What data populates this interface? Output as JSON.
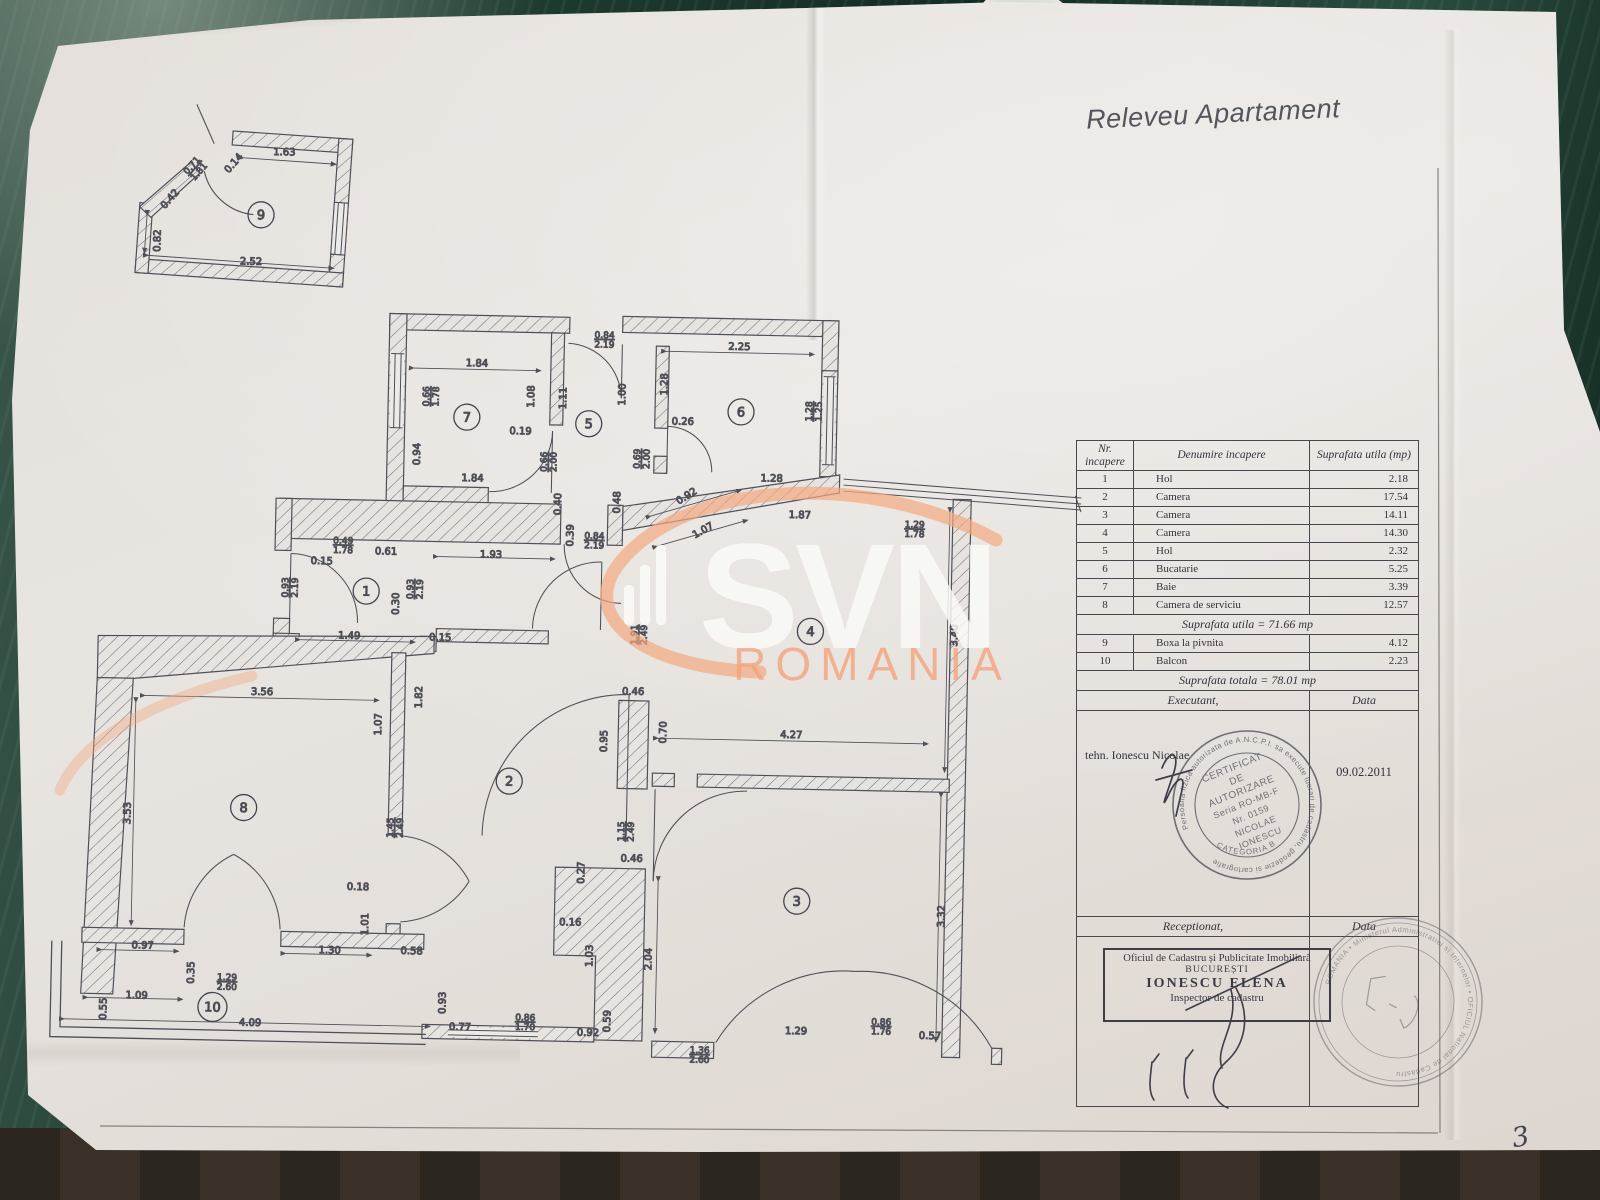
{
  "page": {
    "title": "Releveu Apartament",
    "page_number": "3"
  },
  "watermark": {
    "brand": "SVN",
    "sub": "ROMANIA",
    "accent": "#f2a982"
  },
  "table": {
    "headers": [
      "Nr. incapere",
      "Denumire incapere",
      "Suprafata utila (mp)"
    ],
    "body": [
      {
        "cells": [
          "1",
          "Hol",
          "2.18"
        ]
      },
      {
        "cells": [
          "2",
          "Camera",
          "17.54"
        ]
      },
      {
        "cells": [
          "3",
          "Camera",
          "14.11"
        ]
      },
      {
        "cells": [
          "4",
          "Camera",
          "14.30"
        ]
      },
      {
        "cells": [
          "5",
          "Hol",
          "2.32"
        ]
      },
      {
        "cells": [
          "6",
          "Bucatarie",
          "5.25"
        ]
      },
      {
        "cells": [
          "7",
          "Baie",
          "3.39"
        ]
      },
      {
        "cells": [
          "8",
          "Camera de serviciu",
          "12.57"
        ]
      },
      {
        "merge": "Suprafata utila = 71.66 mp"
      },
      {
        "cells": [
          "9",
          "Boxa  la pivnita",
          "4.12"
        ]
      },
      {
        "cells": [
          "10",
          "Balcon",
          "2.23"
        ]
      },
      {
        "merge": "Suprafata totala = 78.01 mp"
      },
      {
        "pair": [
          "Executant,",
          "Data"
        ]
      },
      {
        "tall": true,
        "left": "tehn. Ionescu Nicolae",
        "right": "09.02.2011",
        "h": 206
      },
      {
        "pair": [
          "Receptionat,",
          "Data"
        ]
      },
      {
        "tall": true,
        "left": "",
        "right": "",
        "h": 170
      }
    ]
  },
  "stamps": {
    "certificat": {
      "ring": "Persoana fizica autorizata de A.N.C.P.I. sa execute lucrari de cadastru, geodezie si cartografie",
      "lines": [
        "CERTIFICAT",
        "DE",
        "AUTORIZARE",
        "Seria RO-MB-F",
        "Nr. 0159",
        "NICOLAE",
        "IONESCU"
      ],
      "category": "CATEGORIA B"
    },
    "ocpi": {
      "lines": [
        "Oficiul de Cadastru și Publicitate Imobiliară",
        "BUCUREȘTI",
        "IONESCU ELENA",
        "Inspector de cadastru"
      ]
    },
    "round2": {
      "ring": "ROMANIA • Ministerul Administratiei si Internelor • OFICIUL National de Cadastru"
    }
  },
  "plan": {
    "rooms": [
      {
        "n": "1",
        "x": 365,
        "y": 596
      },
      {
        "n": "2",
        "x": 512,
        "y": 783
      },
      {
        "n": "3",
        "x": 802,
        "y": 897
      },
      {
        "n": "4",
        "x": 810,
        "y": 627
      },
      {
        "n": "5",
        "x": 584,
        "y": 424
      },
      {
        "n": "6",
        "x": 736,
        "y": 409
      },
      {
        "n": "7",
        "x": 462,
        "y": 420
      },
      {
        "n": "8",
        "x": 247,
        "y": 815
      },
      {
        "n": "9",
        "x": 252,
        "y": 222
      },
      {
        "n": "10",
        "x": 220,
        "y": 1015
      }
    ],
    "labels": [
      {
        "t": "1.63",
        "x": 274,
        "y": 162
      },
      {
        "t": "0.14",
        "x": 226,
        "y": 173,
        "r": -50
      },
      {
        "t": "0.71",
        "t2": "1.81",
        "x": 184,
        "y": 176,
        "r": -50
      },
      {
        "t": "0.42",
        "x": 163,
        "y": 210,
        "r": -50
      },
      {
        "t": "0.82",
        "x": 152,
        "y": 250,
        "r": -90
      },
      {
        "t": "2.52",
        "x": 243,
        "y": 272
      },
      {
        "t": "1.84",
        "x": 471,
        "y": 369
      },
      {
        "t": "0.66",
        "t2": "1.78",
        "x": 424,
        "y": 400,
        "r": -90
      },
      {
        "t": "0.94",
        "x": 416,
        "y": 458,
        "r": -90
      },
      {
        "t": "1.84",
        "x": 469,
        "y": 484
      },
      {
        "t": "1.08",
        "x": 529,
        "y": 398,
        "r": -90
      },
      {
        "t": "0.19",
        "x": 516,
        "y": 436
      },
      {
        "t": "1.11",
        "x": 561,
        "y": 399,
        "r": -90
      },
      {
        "t": "0.84",
        "t2": "2.19",
        "x": 598,
        "y": 338
      },
      {
        "t": "1.00",
        "x": 620,
        "y": 394,
        "r": -90
      },
      {
        "t": "0.66",
        "t2": "2.00",
        "x": 543,
        "y": 463,
        "r": -90
      },
      {
        "t": "0.69",
        "t2": "2.00",
        "x": 636,
        "y": 458,
        "r": -90
      },
      {
        "t": "2.25",
        "x": 733,
        "y": 347
      },
      {
        "t": "1.28",
        "x": 662,
        "y": 383,
        "r": -90
      },
      {
        "t": "0.26",
        "x": 678,
        "y": 423
      },
      {
        "t": "1.28",
        "t2": "1.25",
        "x": 807,
        "y": 407,
        "r": -90
      },
      {
        "t": "1.28",
        "x": 768,
        "y": 478
      },
      {
        "t": "0.92",
        "x": 685,
        "y": 497,
        "r": -33
      },
      {
        "t": "0.40",
        "x": 558,
        "y": 505,
        "r": -90
      },
      {
        "t": "0.48",
        "x": 617,
        "y": 502,
        "r": -90
      },
      {
        "t": "0.39",
        "x": 571,
        "y": 536,
        "r": -90
      },
      {
        "t": "0.84",
        "t2": "2.19",
        "x": 592,
        "y": 539
      },
      {
        "t": "0.49",
        "t2": "1.78",
        "x": 341,
        "y": 549
      },
      {
        "t": "0.61",
        "x": 384,
        "y": 559
      },
      {
        "t": "1.93",
        "x": 489,
        "y": 560
      },
      {
        "t": "0.15",
        "x": 320,
        "y": 570
      },
      {
        "t": "0.93",
        "t2": "2.19",
        "x": 287,
        "y": 594,
        "r": -90
      },
      {
        "t": "0.93",
        "t2": "2.19",
        "x": 412,
        "y": 593,
        "r": -90
      },
      {
        "t": "0.30",
        "x": 398,
        "y": 608,
        "r": -90
      },
      {
        "t": "1.49",
        "x": 349,
        "y": 644
      },
      {
        "t": "0.15",
        "x": 440,
        "y": 644
      },
      {
        "t": "1.87",
        "x": 797,
        "y": 514
      },
      {
        "t": "1.07",
        "x": 702,
        "y": 531,
        "r": -30
      },
      {
        "t": "1.29",
        "t2": "1.78",
        "x": 912,
        "y": 521
      },
      {
        "t": "3.40",
        "x": 957,
        "y": 628,
        "r": -90
      },
      {
        "t": "1.91",
        "t2": "2.49",
        "x": 637,
        "y": 634,
        "r": -90
      },
      {
        "t": "0.46",
        "x": 634,
        "y": 694
      },
      {
        "t": "0.70",
        "x": 668,
        "y": 731,
        "r": -90
      },
      {
        "t": "0.95",
        "x": 609,
        "y": 741,
        "r": -90
      },
      {
        "t": "4.27",
        "x": 793,
        "y": 734
      },
      {
        "t": "3.56",
        "x": 263,
        "y": 702
      },
      {
        "t": "1.82",
        "x": 423,
        "y": 701,
        "r": -90
      },
      {
        "t": "1.07",
        "x": 383,
        "y": 729,
        "r": -90
      },
      {
        "t": "3.53",
        "x": 134,
        "y": 823,
        "r": -90
      },
      {
        "t": "1.45",
        "t2": "2.49",
        "x": 397,
        "y": 832,
        "r": -90
      },
      {
        "t": "1.15",
        "t2": "2.49",
        "x": 628,
        "y": 831,
        "r": -90
      },
      {
        "t": "0.46",
        "x": 636,
        "y": 861
      },
      {
        "t": "0.27",
        "x": 589,
        "y": 873,
        "r": -90
      },
      {
        "t": "0.16",
        "x": 576,
        "y": 926
      },
      {
        "t": "1.03",
        "x": 599,
        "y": 956,
        "r": -90
      },
      {
        "t": "2.04",
        "x": 658,
        "y": 958,
        "r": -90
      },
      {
        "t": "0.93",
        "x": 453,
        "y": 1006,
        "r": -90
      },
      {
        "t": "0.77",
        "x": 468,
        "y": 1033
      },
      {
        "t": "0.86",
        "t2": "1.70",
        "x": 533,
        "y": 1022
      },
      {
        "t": "0.92",
        "x": 596,
        "y": 1036
      },
      {
        "t": "0.59",
        "x": 618,
        "y": 1021,
        "r": -90
      },
      {
        "t": "1.36",
        "t2": "2.60",
        "x": 708,
        "y": 1051
      },
      {
        "t": "3.32",
        "x": 950,
        "y": 909,
        "r": -90
      },
      {
        "t": "1.29",
        "x": 804,
        "y": 1030
      },
      {
        "t": "0.86",
        "t2": "1.76",
        "x": 889,
        "y": 1019
      },
      {
        "t": "0.57",
        "x": 938,
        "y": 1032
      },
      {
        "t": "0.18",
        "x": 363,
        "y": 895
      },
      {
        "t": "1.01",
        "x": 374,
        "y": 929,
        "r": -90
      },
      {
        "t": "0.97",
        "x": 149,
        "y": 958
      },
      {
        "t": "0.35",
        "x": 201,
        "y": 981,
        "r": -90
      },
      {
        "t": "1.29",
        "t2": "2.60",
        "x": 234,
        "y": 988
      },
      {
        "t": "1.30",
        "x": 336,
        "y": 959
      },
      {
        "t": "0.58",
        "x": 418,
        "y": 958
      },
      {
        "t": "1.09",
        "x": 144,
        "y": 1008
      },
      {
        "t": "0.55",
        "x": 114,
        "y": 1019,
        "r": -90
      },
      {
        "t": "4.09",
        "x": 258,
        "y": 1033
      }
    ]
  }
}
